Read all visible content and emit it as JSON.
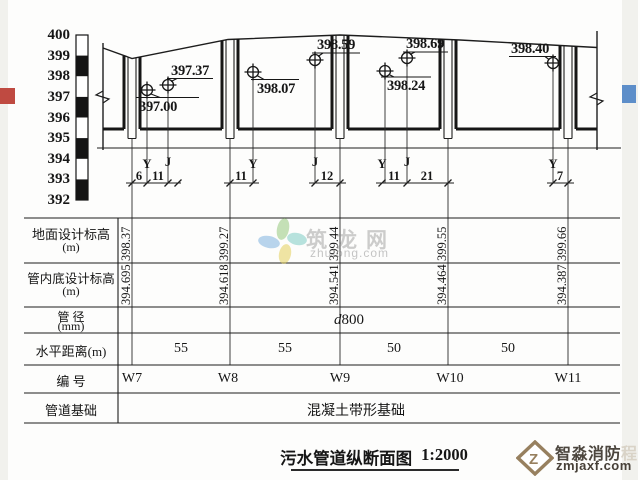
{
  "elevation_scale": {
    "labels": [
      "400",
      "399",
      "398",
      "397",
      "396",
      "395",
      "394",
      "393",
      "392"
    ]
  },
  "profile": {
    "callouts": [
      {
        "value": "397.00"
      },
      {
        "value": "397.37"
      },
      {
        "value": "398.07"
      },
      {
        "value": "398.59"
      },
      {
        "value": "398.24"
      },
      {
        "value": "398.69"
      },
      {
        "value": "398.40"
      }
    ],
    "connection_marks": [
      "Y",
      "J",
      "Y",
      "J",
      "Y",
      "J",
      "Y"
    ],
    "offsets": [
      "6",
      "11",
      "11",
      "12",
      "11",
      "21",
      "7"
    ]
  },
  "table": {
    "rows": {
      "ground": {
        "label": "地面设计标高",
        "unit": "(m)"
      },
      "invert": {
        "label": "管内底设计标高",
        "unit": "(m)"
      },
      "diameter": {
        "label": "管 径",
        "unit": "(mm)",
        "value": "d800"
      },
      "distance": {
        "label": "水平距离(m)",
        "values": [
          "55",
          "55",
          "50",
          "50"
        ]
      },
      "id": {
        "label": "编  号",
        "values": [
          "W7",
          "W8",
          "W9",
          "W10",
          "W11"
        ]
      },
      "foundation": {
        "label": "管道基础",
        "value": "混凝土带形基础"
      }
    },
    "columns": [
      {
        "id": "W7",
        "ground": "398.37",
        "invert": "394.695"
      },
      {
        "id": "W8",
        "ground": "399.27",
        "invert": "394.618"
      },
      {
        "id": "W9",
        "ground": "399.44",
        "invert": "394.541"
      },
      {
        "id": "W10",
        "ground": "399.55",
        "invert": "394.464"
      },
      {
        "id": "W11",
        "ground": "399.66",
        "invert": "394.387"
      }
    ]
  },
  "title": {
    "text": "污水管道纵断面图",
    "scale": "1:2000"
  },
  "watermark": {
    "name": "筑龙网",
    "url": "zhulong.com"
  },
  "logo": {
    "name": "智淼消防",
    "suffix": "程",
    "url": "zmjaxf.com"
  },
  "colors": {
    "left_marker": "#bf4a41",
    "right_marker": "#5d8ec9"
  }
}
